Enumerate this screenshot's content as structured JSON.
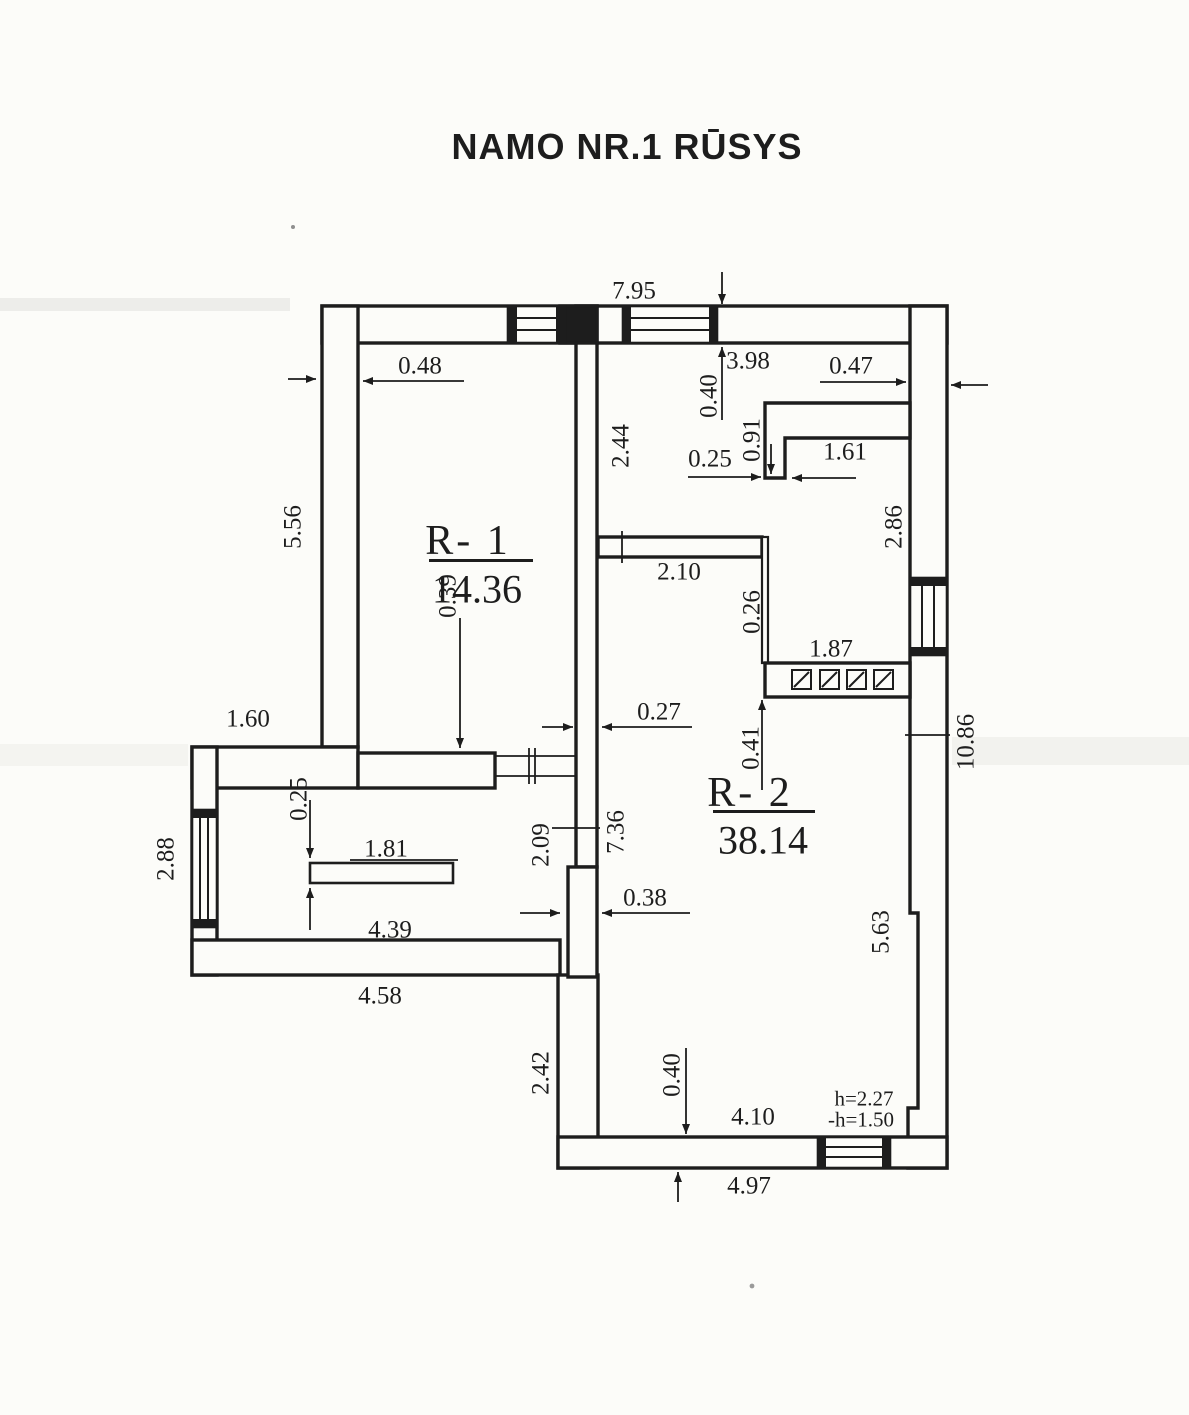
{
  "title": "NAMO NR.1 RŪSYS",
  "rooms": [
    {
      "id": "R-1",
      "label": "R- 1",
      "area": "14.36"
    },
    {
      "id": "R-2",
      "label": "R- 2",
      "area": "38.14"
    }
  ],
  "colors": {
    "ink": "#1d1d1d",
    "paper": "#fcfcf9"
  },
  "dimensions": [
    {
      "v": "7.95",
      "x": 634,
      "y": 291
    },
    {
      "v": "0.48",
      "x": 420,
      "y": 366
    },
    {
      "v": "3.98",
      "x": 748,
      "y": 361
    },
    {
      "v": "0.40",
      "x": 709,
      "y": 396,
      "rot": 1
    },
    {
      "v": "0.47",
      "x": 851,
      "y": 366
    },
    {
      "v": "0.91",
      "x": 752,
      "y": 440,
      "rot": 1
    },
    {
      "v": "0.25",
      "x": 710,
      "y": 459
    },
    {
      "v": "1.61",
      "x": 845,
      "y": 452
    },
    {
      "v": "2.44",
      "x": 621,
      "y": 446,
      "rot": 1
    },
    {
      "v": "5.56",
      "x": 293,
      "y": 527,
      "rot": 1
    },
    {
      "v": "2.86",
      "x": 894,
      "y": 527,
      "rot": 1
    },
    {
      "v": "2.10",
      "x": 679,
      "y": 572
    },
    {
      "v": "0.26",
      "x": 752,
      "y": 612,
      "rot": 1
    },
    {
      "v": "1.87",
      "x": 831,
      "y": 649
    },
    {
      "v": "0.27",
      "x": 659,
      "y": 712
    },
    {
      "v": "0.39",
      "x": 448,
      "y": 596,
      "rot": 1
    },
    {
      "v": "1.60",
      "x": 248,
      "y": 719
    },
    {
      "v": "10.86",
      "x": 966,
      "y": 742,
      "rot": 1
    },
    {
      "v": "0.25",
      "x": 299,
      "y": 799,
      "rot": 1
    },
    {
      "v": "1.81",
      "x": 386,
      "y": 849
    },
    {
      "v": "2.88",
      "x": 166,
      "y": 859,
      "rot": 1
    },
    {
      "v": "0.41",
      "x": 751,
      "y": 748,
      "rot": 1
    },
    {
      "v": "7.36",
      "x": 616,
      "y": 832,
      "rot": 1
    },
    {
      "v": "2.09",
      "x": 541,
      "y": 845,
      "rot": 1
    },
    {
      "v": "0.38",
      "x": 645,
      "y": 898
    },
    {
      "v": "5.63",
      "x": 881,
      "y": 932,
      "rot": 1
    },
    {
      "v": "4.39",
      "x": 390,
      "y": 930
    },
    {
      "v": "4.58",
      "x": 380,
      "y": 996
    },
    {
      "v": "2.42",
      "x": 541,
      "y": 1073,
      "rot": 1
    },
    {
      "v": "0.40",
      "x": 672,
      "y": 1075,
      "rot": 1
    },
    {
      "v": "4.10",
      "x": 753,
      "y": 1117
    },
    {
      "v": "h=2.27",
      "x": 864,
      "y": 1099,
      "small": 1
    },
    {
      "v": "-h=1.50",
      "x": 861,
      "y": 1120,
      "small": 1
    },
    {
      "v": "4.97",
      "x": 749,
      "y": 1186
    }
  ]
}
